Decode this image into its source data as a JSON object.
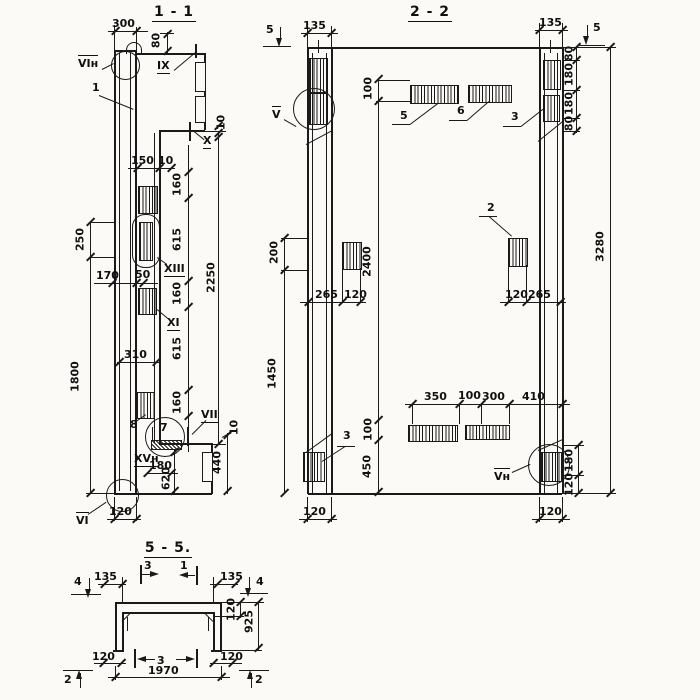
{
  "colors": {
    "ink": "#1a1a1a",
    "paper": "#fbfaf7"
  },
  "s11": {
    "title": "1 - 1",
    "d300": "300",
    "d80": "80",
    "d10a": "10",
    "d150": "150",
    "d10b": "10",
    "c160a": "160",
    "c615a": "615",
    "c160b": "160",
    "c615b": "615",
    "c160c": "160",
    "d2250": "2250",
    "d250": "250",
    "d1800": "1800",
    "d170": "170",
    "d50": "50",
    "d310": "310",
    "d180": "180",
    "d620": "620",
    "d10c": "10",
    "d440": "440",
    "d120": "120",
    "m_vin": "VIн",
    "m_ix": "IX",
    "m_x": "X",
    "m_xiii": "XIII",
    "m_xi": "XI",
    "m_vii": "VII",
    "m_xvn": "XVн",
    "m_vi": "VI",
    "c1": "1",
    "c7": "7",
    "c8": "8"
  },
  "s22": {
    "title": "2 - 2",
    "cut5l": "5",
    "d135l": "135",
    "d135r": "135",
    "cut5r": "5",
    "d80a": "80",
    "d180a": "180",
    "d180b": "180",
    "d80b": "80",
    "d100t": "100",
    "c5": "5",
    "c6": "6",
    "c3t": "3",
    "c2": "2",
    "d3280": "3280",
    "d2400": "2400",
    "d200": "200",
    "d265l": "265",
    "d120l": "120",
    "d120r2": "120",
    "d265r": "265",
    "d1450": "1450",
    "d350": "350",
    "d100m": "100",
    "d300": "300",
    "d410": "410",
    "d100b": "100",
    "d450": "450",
    "c3b": "3",
    "m_v": "V",
    "m_vn": "Vн",
    "d180br": "180",
    "d120br": "120",
    "d120botl": "120",
    "d120botr": "120"
  },
  "s55": {
    "title": "5 - 5.",
    "cut4l": "4",
    "d135l": "135",
    "cut3t": "3",
    "cut1t": "1",
    "d135r": "135",
    "cut4r": "4",
    "d120r": "120",
    "d925": "925",
    "d120bl": "120",
    "cut3b": "3",
    "d120br": "120",
    "d1970": "1970",
    "cut2l": "2",
    "cut2r": "2"
  }
}
